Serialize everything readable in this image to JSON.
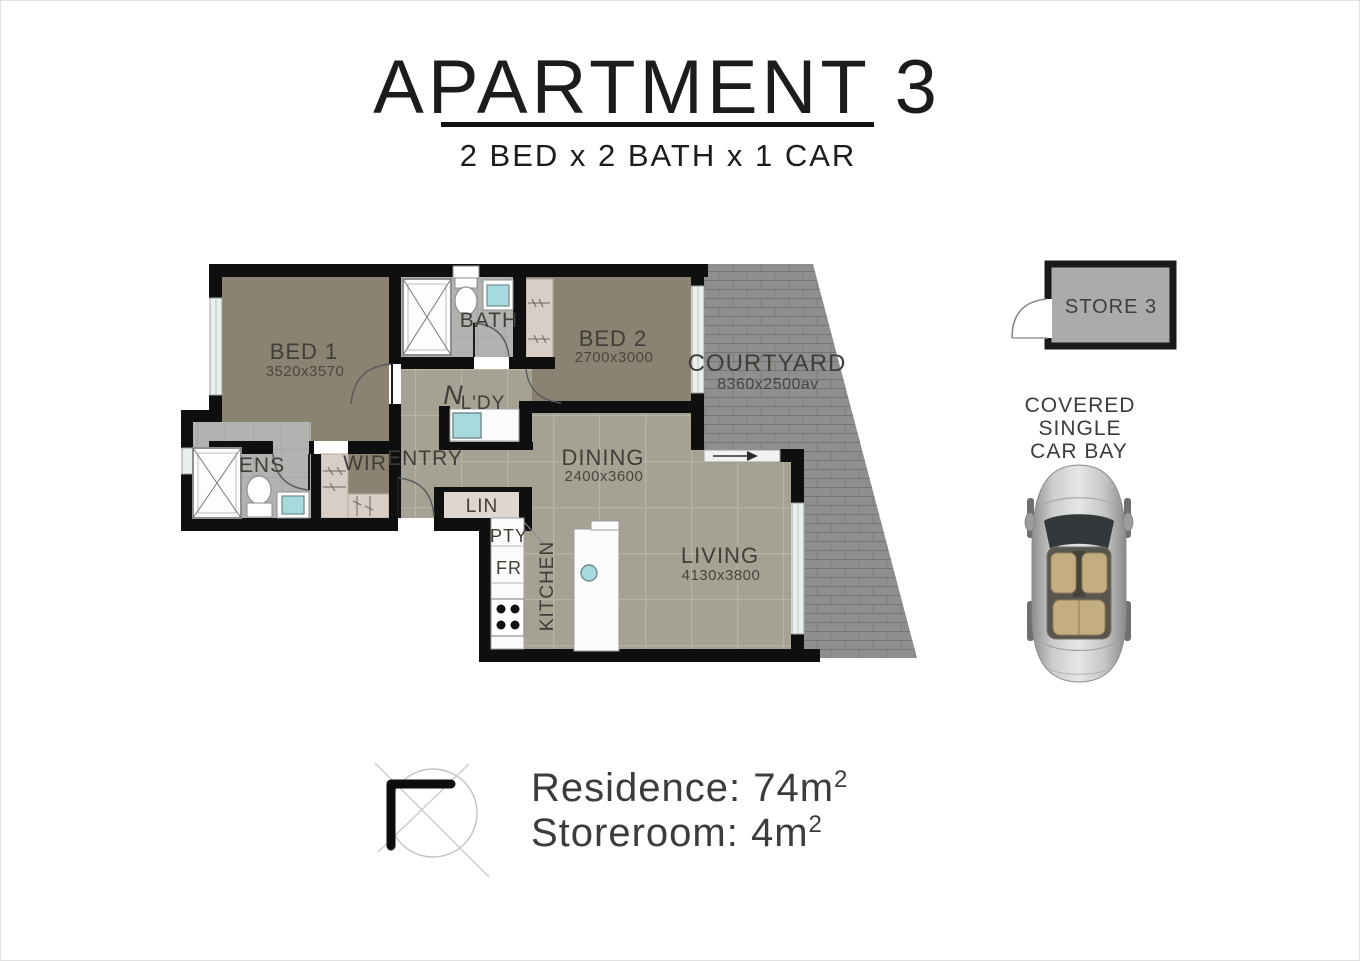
{
  "title": "APARTMENT 3",
  "subtitle": "2 BED x 2 BATH x 1 CAR",
  "rooms": {
    "bed1": {
      "label": "BED 1",
      "dims": "3520x3570"
    },
    "bed2": {
      "label": "BED 2",
      "dims": "2700x3000"
    },
    "bath": {
      "label": "BATH"
    },
    "ens": {
      "label": "ENS"
    },
    "wir": {
      "label": "WIR"
    },
    "entry": {
      "label": "ENTRY"
    },
    "ldy": {
      "label": "L'DY"
    },
    "lin": {
      "label": "LIN"
    },
    "pty": {
      "label": "PTY"
    },
    "fr": {
      "label": "FR"
    },
    "kitchen": {
      "label": "KITCHEN"
    },
    "dining": {
      "label": "DINING",
      "dims": "2400x3600"
    },
    "living": {
      "label": "LIVING",
      "dims": "4130x3800"
    },
    "courtyard": {
      "label": "COURTYARD",
      "dims": "8360x2500av"
    }
  },
  "store": {
    "label": "STORE 3"
  },
  "car_bay": {
    "line1": "COVERED",
    "line2": "SINGLE",
    "line3": "CAR BAY"
  },
  "areas": {
    "residence": "Residence: 74m",
    "residence_sup": "2",
    "storeroom": "Storeroom: 4m",
    "storeroom_sup": "2"
  },
  "symbols": {
    "washing_machine": "N"
  },
  "colors": {
    "wall": "#0f0f0f",
    "carpet": "#8b8371",
    "tile": "#a5a294",
    "tile_grout": "#b7b4a5",
    "wet_floor": "#b2b2b0",
    "courtyard_paving": "#8f8f8f",
    "robe_shelf": "#d9cec6",
    "fixture_cyan": "#a7dade",
    "window": "#eaf0ed",
    "store_fill": "#ababab"
  }
}
